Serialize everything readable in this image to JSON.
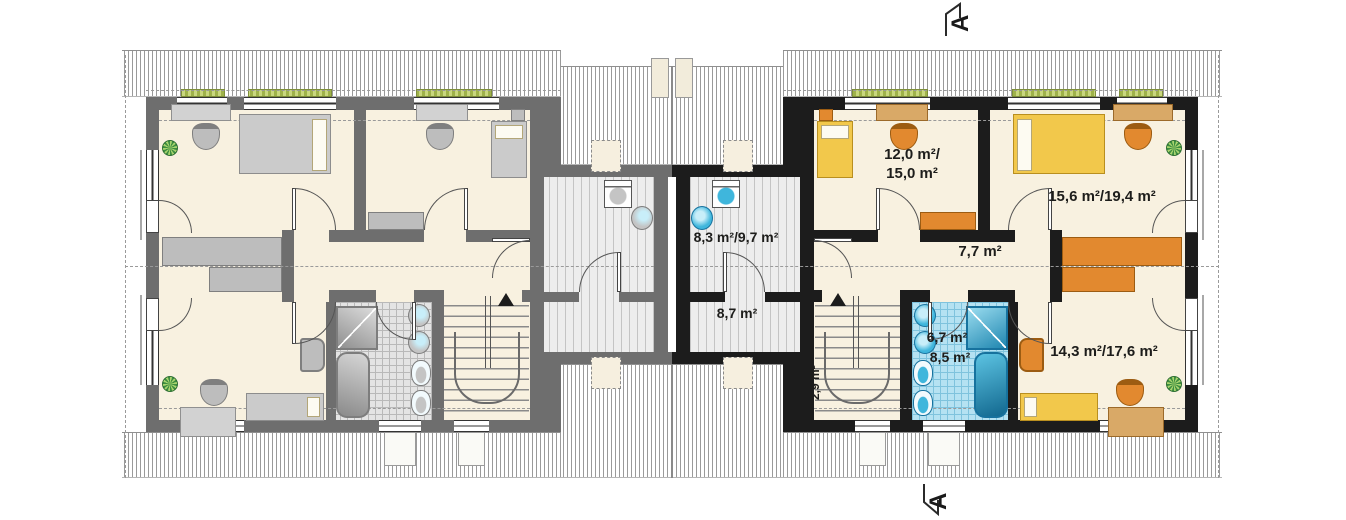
{
  "plan": {
    "type": "attic floor plan, semi-detached twin house (left unit mirrored in gray)",
    "section_markers": {
      "top": "A",
      "bottom": "A"
    },
    "labels": {
      "bedroom_small_l1": "12,0 m²/",
      "bedroom_small_l2": "15,0 m²",
      "bedroom_large": "15,6 m²/19,4 m²",
      "hall": "7,7 m²",
      "laundry": "8,3 m²/9,7 m²",
      "storage": "8,7 m²",
      "stairs": "2,9 m²",
      "bathroom_l1": "6,7 m²",
      "bathroom_l2": "8,5 m²",
      "bedroom_rear": "14,3 m²/17,6 m²"
    },
    "colors": {
      "wall_right": "#1c1c1c",
      "wall_mirror": "#6e6e6e",
      "floor": "#f8f1e0",
      "bed": "#f2c84b",
      "furniture": "#e2892f",
      "wood": "#d9a967",
      "tile": "#b5e2f2",
      "fixture": "#3fb6dc",
      "hatch": "#9a9a9a"
    }
  }
}
